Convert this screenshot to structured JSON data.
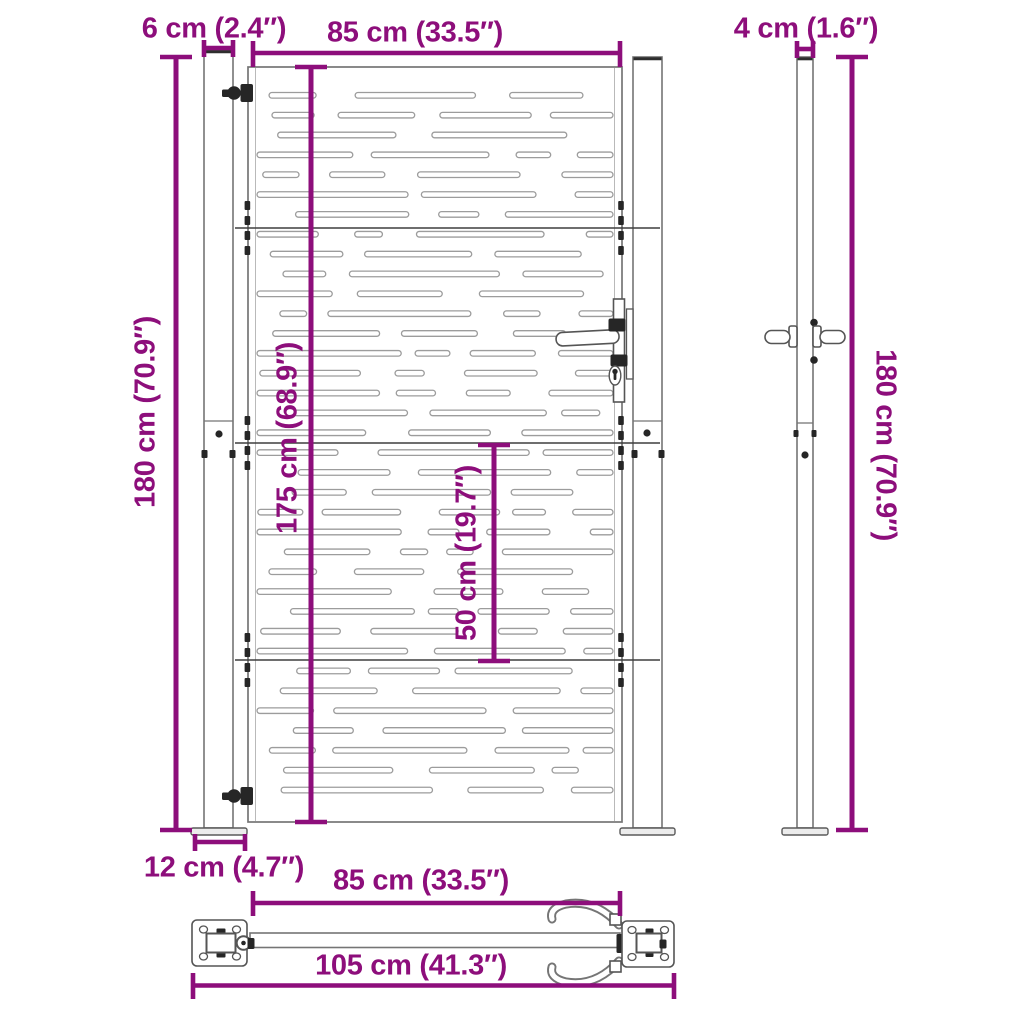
{
  "colors": {
    "dimension": "#8D0E7B",
    "outline": "#757575",
    "slot_outline": "#9c9c9c",
    "detail_dark": "#262626",
    "background": "#ffffff"
  },
  "diagram": {
    "kind": "product-dimension-diagram",
    "subject": "metal garden gate with two posts (front view, side view, top view)"
  },
  "dimensions": {
    "top_left": "6 cm (2.4″)",
    "top_center": "85 cm (33.5″)",
    "top_right": "4 cm (1.6″)",
    "left_height": "180 cm (70.9″)",
    "gate_height": "175 cm (68.9″)",
    "lower_section": "50 cm (19.7″)",
    "right_height": "180 cm (70.9″)",
    "base_plate": "12 cm (4.7″)",
    "bottom_width": "85 cm (33.5″)",
    "total_width": "105 cm (41.3″)"
  }
}
